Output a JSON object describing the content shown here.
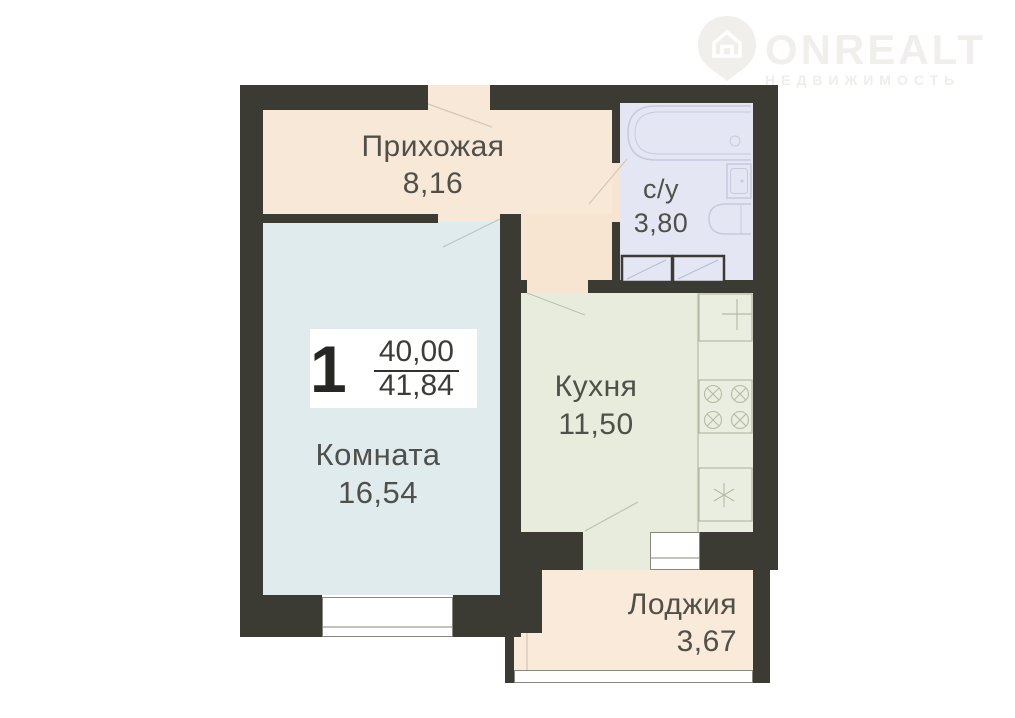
{
  "watermark": {
    "brand": "ONREALT",
    "subtitle": "НЕДВИЖИМОСТЬ"
  },
  "summary": {
    "rooms_count": "1",
    "area_living": "40,00",
    "area_total": "41,84"
  },
  "rooms": {
    "hallway": {
      "name": "Прихожая",
      "area": "8,16"
    },
    "bathroom": {
      "name": "с/у",
      "area": "3,80"
    },
    "living": {
      "name": "Комната",
      "area": "16,54"
    },
    "kitchen": {
      "name": "Кухня",
      "area": "11,50"
    },
    "loggia": {
      "name": "Лоджия",
      "area": "3,67"
    }
  },
  "colors": {
    "wall": "#3b3a33",
    "hallway_floor": "#f8e8d7",
    "living_floor": "#e0ebee",
    "kitchen_floor": "#e7ecdd",
    "bathroom_floor": "#e4e6f4",
    "loggia_floor": "#f9ead9",
    "label_text": "#50504a",
    "watermark": "#f1efeb"
  }
}
